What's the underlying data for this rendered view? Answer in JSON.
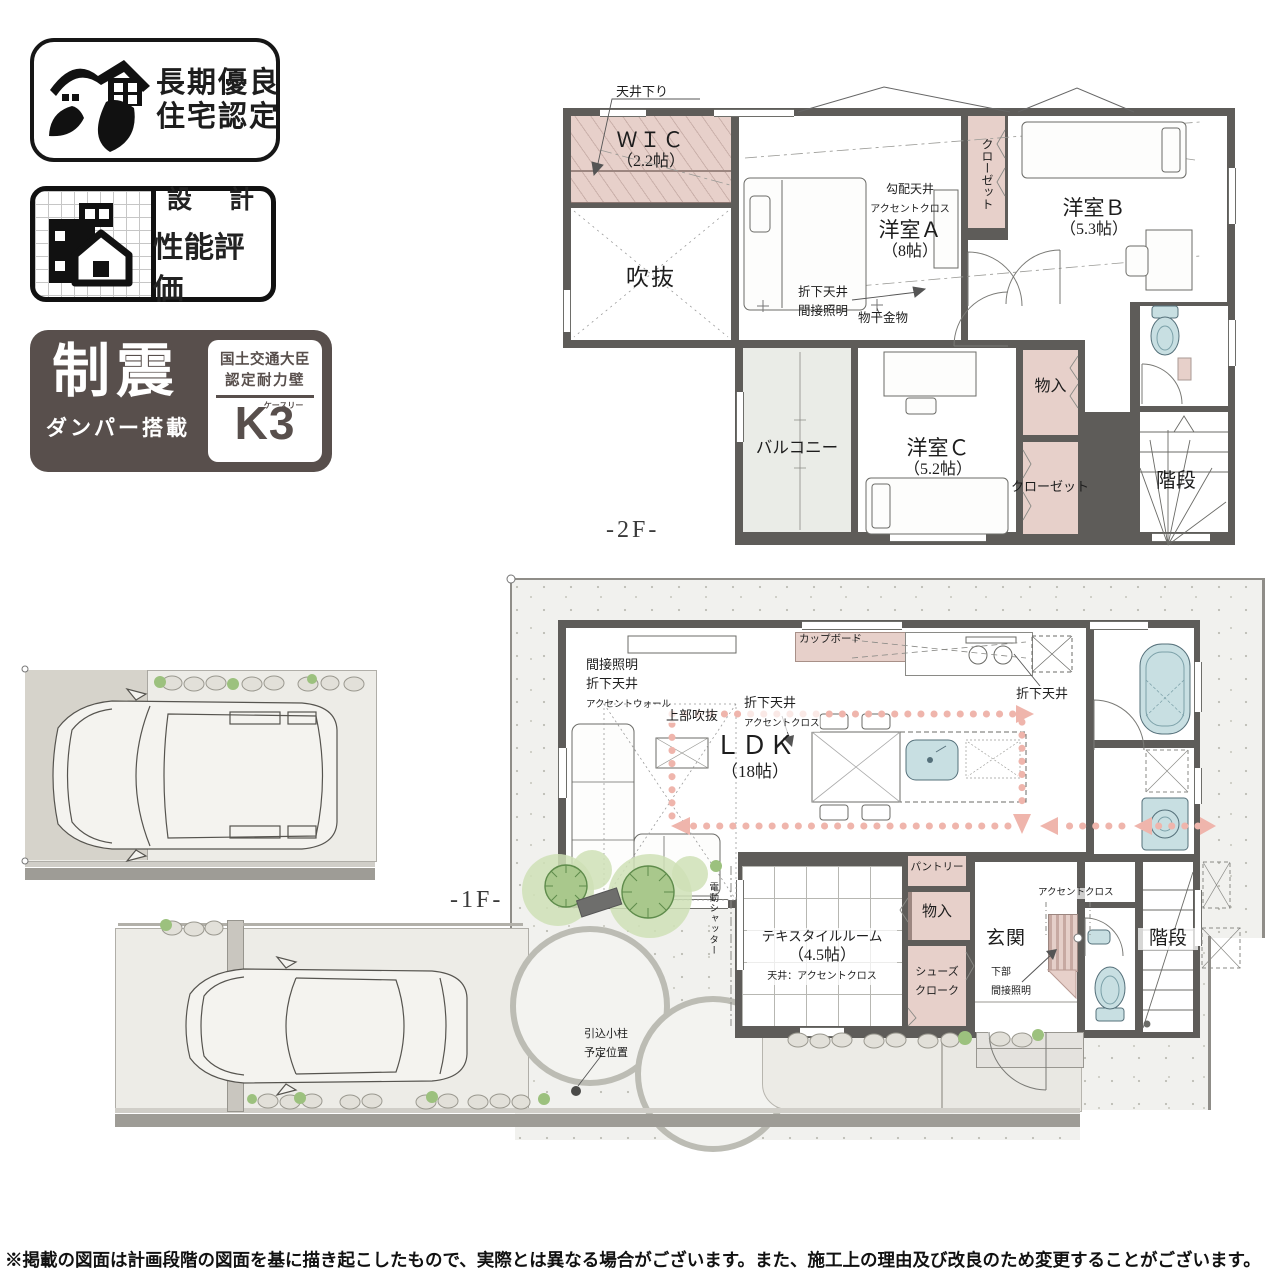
{
  "badges": {
    "longlife": {
      "line1": "長期優良",
      "line2": "住宅認定"
    },
    "design": {
      "top": "設　計",
      "bottom": "性能評価"
    },
    "damper": {
      "main": "制震",
      "sub": "ダンパー搭載",
      "cert1": "国土交通大臣",
      "cert2": "認定耐力壁",
      "mark": "K3",
      "kana": "ケースリー"
    }
  },
  "f2": {
    "label": "-2F-",
    "wic_name": "ＷＩＣ",
    "wic_size": "（2.2帖）",
    "void_name": "吹抜",
    "ya_note1": "勾配天井",
    "ya_note2": "アクセントクロス",
    "ya_name": "洋室Ａ",
    "ya_size": "（8帖）",
    "yb_name": "洋室Ｂ",
    "yb_size": "（5.3帖）",
    "yc_name": "洋室Ｃ",
    "yc_size": "（5.2帖）",
    "balcony": "バルコニー",
    "closet_a": "クローゼット",
    "closet_c": "クローゼット",
    "monoire": "物入",
    "stairs": "階段",
    "tenjo_sagari": "天井下り",
    "orishita1": "折下天井",
    "orishita2": "間接照明",
    "monohoshi": "物干金物"
  },
  "f1": {
    "label": "-1F-",
    "ldk_name": "ＬＤＫ",
    "ldk_size": "（18帖）",
    "note_kansetsu1": "間接照明",
    "note_kansetsu2": "折下天井",
    "note_kansetsu3": "アクセントウォール",
    "note_jobu": "上部吹抜",
    "note_orishita1": "折下天井",
    "note_orishita2": "アクセントクロス",
    "cupboard": "カップボード",
    "note_kitchen": "折下天井",
    "textile_name": "テキスタイルルーム",
    "textile_size": "（4.5帖）",
    "textile_note": "天井：アクセントクロス",
    "pantry": "パントリー",
    "monoire": "物入",
    "shoes1": "シューズ",
    "shoes2": "クローク",
    "genkan": "玄関",
    "accent": "アクセントクロス",
    "kabu1": "下部",
    "kabu2": "間接照明",
    "stairs": "階段",
    "shutter": "電動シャッター",
    "pole1": "引込小柱",
    "pole2": "予定位置"
  },
  "footer": {
    "disclaimer": "※掲載の図面は計画段階の図面を基に描き起こしたもので、実際とは異なる場合がございます。また、施工上の理由及び改良のため変更することがございます。"
  }
}
